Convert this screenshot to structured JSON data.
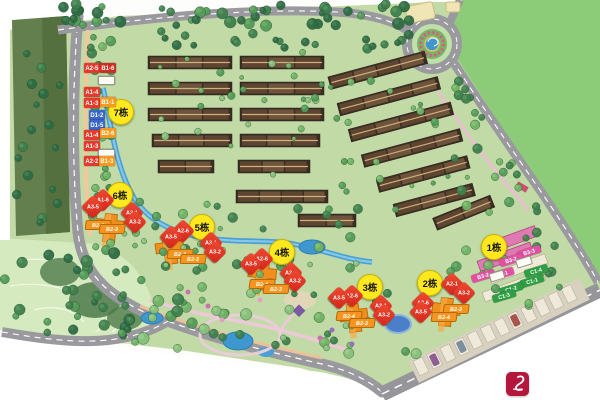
{
  "palette": {
    "marker_bg": "#ffe91e",
    "marker_border": "#cdb400",
    "red_label": "#e6392b",
    "dark_red_label": "#cf2f22",
    "orange_label": "#f59a1f",
    "blue_label": "#3a66c6",
    "pink_label": "#e0519f",
    "green_label": "#2f9e44",
    "road": "#9a9a9e",
    "water": "#3f97d0",
    "lawn": "#8ccb77",
    "site_green": "#c2dba6",
    "logo_red": "#b5163c"
  },
  "map": {
    "building_markers": [
      {
        "label": "7栋",
        "x": 121,
        "y": 112
      },
      {
        "label": "6栋",
        "x": 120,
        "y": 195
      },
      {
        "label": "5栋",
        "x": 202,
        "y": 227
      },
      {
        "label": "4栋",
        "x": 282,
        "y": 252
      },
      {
        "label": "3栋",
        "x": 370,
        "y": 287
      },
      {
        "label": "2栋",
        "x": 430,
        "y": 283
      },
      {
        "label": "1栋",
        "x": 494,
        "y": 247
      }
    ],
    "left_stack": [
      {
        "text": "A2-5",
        "color": "red",
        "x": 84,
        "y": 63,
        "w": 16,
        "h": 10
      },
      {
        "text": "B1-6",
        "color": "darkred",
        "x": 100,
        "y": 63,
        "w": 16,
        "h": 10
      },
      {
        "text": "",
        "color": "white",
        "x": 98,
        "y": 76,
        "w": 15,
        "h": 7
      },
      {
        "text": "A1-4",
        "color": "red",
        "x": 84,
        "y": 87,
        "w": 16,
        "h": 10
      },
      {
        "text": "A1-3",
        "color": "red",
        "x": 84,
        "y": 98,
        "w": 16,
        "h": 10
      },
      {
        "text": "B1-1",
        "color": "orange",
        "x": 100,
        "y": 97,
        "w": 16,
        "h": 10
      },
      {
        "text": "D1-2",
        "color": "blue",
        "x": 89,
        "y": 110,
        "w": 16,
        "h": 10
      },
      {
        "text": "D1-5",
        "color": "blue",
        "x": 89,
        "y": 120,
        "w": 16,
        "h": 10
      },
      {
        "text": "A1-4",
        "color": "red",
        "x": 84,
        "y": 130,
        "w": 16,
        "h": 10
      },
      {
        "text": "B2-6",
        "color": "orange",
        "x": 100,
        "y": 128,
        "w": 16,
        "h": 10
      },
      {
        "text": "A1-3",
        "color": "red",
        "x": 84,
        "y": 141,
        "w": 16,
        "h": 10
      },
      {
        "text": "",
        "color": "white",
        "x": 98,
        "y": 149,
        "w": 15,
        "h": 7
      },
      {
        "text": "A2-2",
        "color": "red",
        "x": 84,
        "y": 156,
        "w": 16,
        "h": 10
      },
      {
        "text": "B1-3",
        "color": "orange",
        "x": 99,
        "y": 156,
        "w": 16,
        "h": 10
      }
    ],
    "unit_labels": [
      {
        "text": "A1-6",
        "x": 103,
        "y": 200,
        "style": "red"
      },
      {
        "text": "A3-5",
        "x": 93,
        "y": 207,
        "style": "red"
      },
      {
        "text": "A3-1",
        "x": 132,
        "y": 213,
        "style": "red"
      },
      {
        "text": "A3-2",
        "x": 135,
        "y": 222,
        "style": "red"
      },
      {
        "text": "B2-4",
        "x": 98,
        "y": 225,
        "style": "orange"
      },
      {
        "text": "B2-3",
        "x": 112,
        "y": 229,
        "style": "orange"
      },
      {
        "text": "A2-6",
        "x": 183,
        "y": 231,
        "style": "red"
      },
      {
        "text": "A3-5",
        "x": 171,
        "y": 237,
        "style": "red"
      },
      {
        "text": "A3-1",
        "x": 211,
        "y": 243,
        "style": "red"
      },
      {
        "text": "A3-2",
        "x": 215,
        "y": 252,
        "style": "red"
      },
      {
        "text": "B2-4",
        "x": 180,
        "y": 254,
        "style": "orange"
      },
      {
        "text": "B2-3",
        "x": 193,
        "y": 259,
        "style": "orange"
      },
      {
        "text": "A2-6",
        "x": 262,
        "y": 259,
        "style": "red"
      },
      {
        "text": "A3-5",
        "x": 251,
        "y": 264,
        "style": "red"
      },
      {
        "text": "A2-1",
        "x": 291,
        "y": 273,
        "style": "red"
      },
      {
        "text": "A3-2",
        "x": 295,
        "y": 281,
        "style": "red"
      },
      {
        "text": "B2-4",
        "x": 262,
        "y": 284,
        "style": "orange"
      },
      {
        "text": "B2-3",
        "x": 276,
        "y": 289,
        "style": "orange"
      },
      {
        "text": "A2-6",
        "x": 352,
        "y": 296,
        "style": "red"
      },
      {
        "text": "A3-5",
        "x": 339,
        "y": 298,
        "style": "red"
      },
      {
        "text": "A2-1",
        "x": 381,
        "y": 306,
        "style": "red"
      },
      {
        "text": "A3-2",
        "x": 384,
        "y": 315,
        "style": "red"
      },
      {
        "text": "B2-4",
        "x": 349,
        "y": 316,
        "style": "orange"
      },
      {
        "text": "B2-3",
        "x": 362,
        "y": 323,
        "style": "orange"
      },
      {
        "text": "A2-1",
        "x": 452,
        "y": 284,
        "style": "red"
      },
      {
        "text": "A3-2",
        "x": 464,
        "y": 293,
        "style": "red"
      },
      {
        "text": "A2-6",
        "x": 423,
        "y": 303,
        "style": "red"
      },
      {
        "text": "A3-5",
        "x": 421,
        "y": 312,
        "style": "red"
      },
      {
        "text": "B2-3",
        "x": 456,
        "y": 309,
        "style": "orange"
      },
      {
        "text": "B2-4",
        "x": 444,
        "y": 317,
        "style": "orange"
      }
    ],
    "pink_labels": [
      {
        "text": "B3-3",
        "x": 529,
        "y": 252
      },
      {
        "text": "B3-2",
        "x": 511,
        "y": 260
      },
      {
        "text": "B3-1",
        "x": 502,
        "y": 274
      },
      {
        "text": "B3-2",
        "x": 483,
        "y": 276
      }
    ],
    "green_labels": [
      {
        "text": "C1-4",
        "x": 536,
        "y": 271
      },
      {
        "text": "C1-1",
        "x": 532,
        "y": 281
      },
      {
        "text": "C1-2",
        "x": 511,
        "y": 289
      },
      {
        "text": "C1-3",
        "x": 504,
        "y": 296
      }
    ],
    "white_boxes": [
      {
        "x": 524,
        "y": 262,
        "w": 14,
        "h": 7
      },
      {
        "x": 497,
        "y": 276,
        "w": 13,
        "h": 7
      }
    ]
  }
}
